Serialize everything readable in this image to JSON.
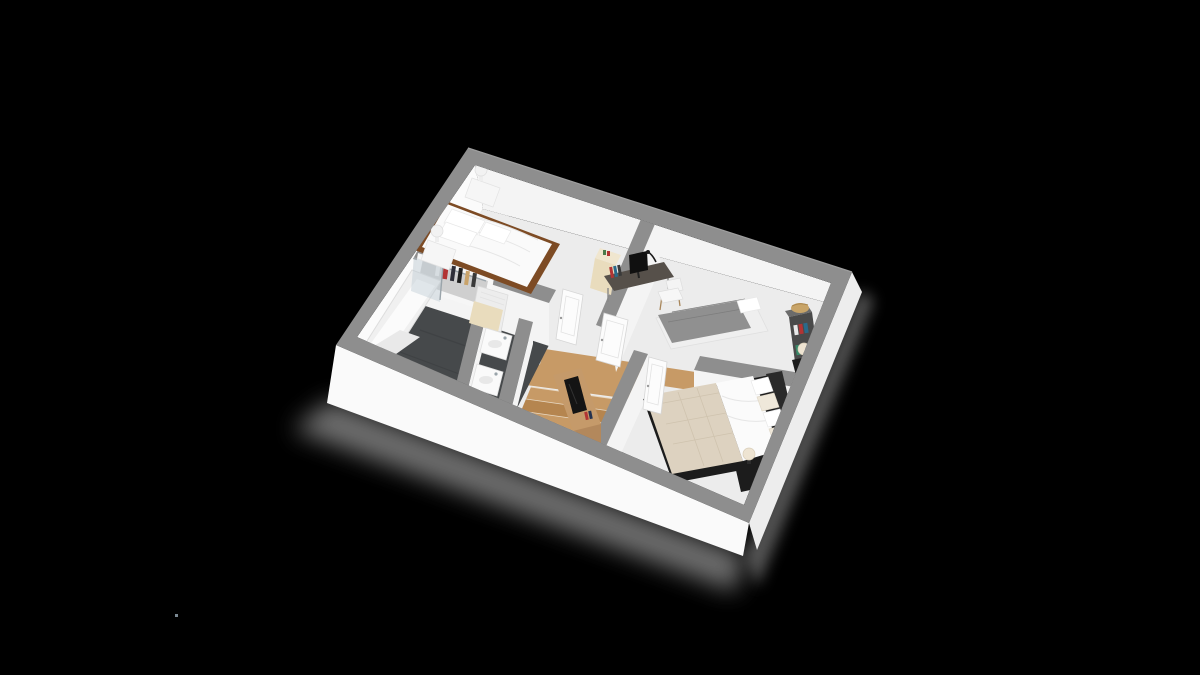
{
  "scene": {
    "title": "3D isometric floor plan render, upper storey",
    "view": "isometric-top-down",
    "background": "#000000",
    "artifact": "tiny stray light pixel bottom-left"
  },
  "palette": {
    "background": "#000000",
    "wall_top": "#8e8e8e",
    "wall_face": "#f4f4f4",
    "wall_face_bright": "#fbfbfb",
    "floor_main": "#ececec",
    "floor_bath": "#46494b",
    "wood": "#c79a66",
    "wood_dark": "#b5854f",
    "plinth": "#fafafa",
    "plinth_shade": "#ededed",
    "shadow": "#8a8a8a",
    "white_furniture": "#f6f6f6",
    "bed_frame": "#7d4b24",
    "quilt": "#ddd2c0",
    "sheet": "#fbfbfb",
    "gray_bed": "#909090",
    "desk_top": "#56504a",
    "oak": "#c59a6a",
    "oak_dark": "#b3885c",
    "black_furniture": "#1c1c1c",
    "cream": "#e9dcbd",
    "glass": "#b9c7d2",
    "red_accent": "#b23434",
    "basket": "#c8a468",
    "door": "#fcfcfc"
  },
  "rooms": [
    {
      "id": "bedroom-1",
      "label": "Bedroom with double bed"
    },
    {
      "id": "study-bedroom",
      "label": "Bedroom with single bed and desk"
    },
    {
      "id": "master-bedroom",
      "label": "Master bedroom"
    },
    {
      "id": "bathroom",
      "label": "Bathroom"
    },
    {
      "id": "hallway",
      "label": "Landing with staircase"
    }
  ],
  "furniture": {
    "bedroom1": [
      "double-bed-white",
      "nightstand-lamp-left",
      "nightstand-lamp-right"
    ],
    "study": [
      "desk-with-monitor",
      "desk-chair",
      "single-bed-gray",
      "bookshelf-with-basket",
      "cream-cabinet"
    ],
    "master": [
      "double-bed-quilt",
      "black-nightstand-a",
      "black-nightstand-b",
      "tv-stand-oak"
    ],
    "bathroom": [
      "bathtub-with-shower-screen",
      "open-wardrobe-clothes",
      "towel-radiator",
      "washbasin-1",
      "washbasin-2"
    ],
    "hallway": [
      "staircase-wood",
      "door-bedroom-1",
      "door-study",
      "door-master"
    ]
  }
}
